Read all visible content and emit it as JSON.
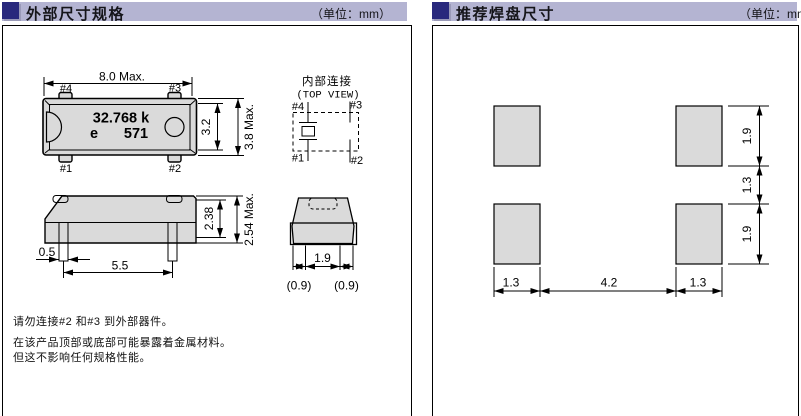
{
  "panels": {
    "left": {
      "title": "外部尺寸规格",
      "unit": "（单位：mm）",
      "top_view": {
        "dim_width": "8.0 Max.",
        "pin4": "#4",
        "pin3": "#3",
        "pin1": "#1",
        "pin2": "#2",
        "marking_line1": "32.768 k",
        "marking_logo": "e",
        "marking_code": "571",
        "dim_body_height": "3.2",
        "dim_total_height": "3.8 Max."
      },
      "internal_connection": {
        "title": "内部连接",
        "subtitle": "(TOP VIEW)",
        "pin4": "#4",
        "pin3": "#3",
        "pin1": "#1",
        "pin2": "#2"
      },
      "side_view": {
        "dim_lead_width": "0.5",
        "dim_lead_span": "5.5",
        "dim_body_height": "2.38",
        "dim_total_height": "2.54 Max."
      },
      "end_view": {
        "dim_lead_gap": "1.9",
        "dim_left": "(0.9)",
        "dim_right": "(0.9)"
      },
      "notes": [
        "请勿连接#2 和#3 到外部器件。",
        "在该产品顶部或底部可能暴露着金属材料。",
        "但这不影响任何规格性能。"
      ]
    },
    "right": {
      "title": "推荐焊盘尺寸",
      "unit": "（单位：mm）",
      "pad_layout": {
        "dim_pad_height_top": "1.9",
        "dim_row_gap": "1.3",
        "dim_pad_height_bottom": "1.9",
        "dim_pad_width_left": "1.3",
        "dim_col_gap": "4.2",
        "dim_pad_width_right": "1.3"
      }
    }
  },
  "colors": {
    "header_bar": "#b4b4d2",
    "header_square": "#29297d",
    "drawing_fill": "#dadada",
    "line": "#000000"
  }
}
